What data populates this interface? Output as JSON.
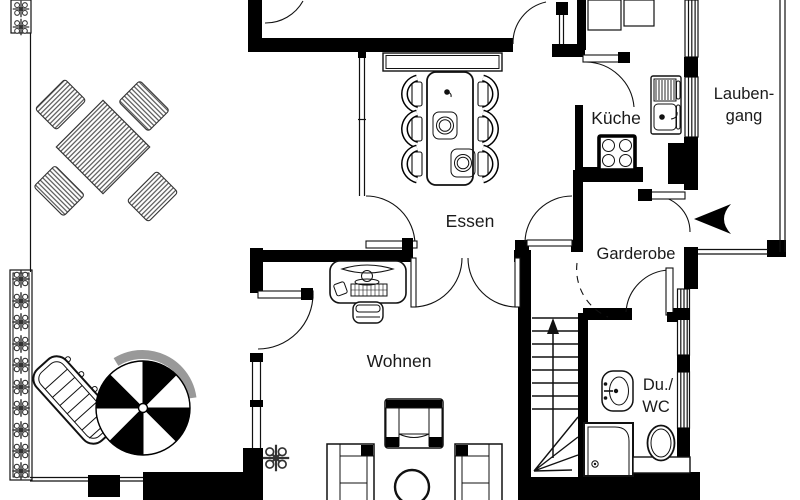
{
  "plan": {
    "type": "apartment-floor-plan",
    "rooms": {
      "essen": {
        "label": "Essen"
      },
      "kueche": {
        "label": "Küche"
      },
      "laubengang": {
        "label_lines": [
          "Lauben-",
          "gang"
        ]
      },
      "garderobe": {
        "label": "Garderobe"
      },
      "wohnen": {
        "label": "Wohnen"
      },
      "du_wc": {
        "label_lines": [
          "Du./",
          "WC"
        ]
      }
    },
    "colors": {
      "wall": "#000000",
      "background": "#ffffff",
      "line": "#111111",
      "parasol_shadow": "#999999"
    },
    "symbols": {
      "terrace": [
        "outdoor-dining-set",
        "parasol",
        "sun-lounger",
        "hedge"
      ],
      "essen": [
        "dining-table",
        "dining-chairs",
        "sideboard",
        "place-settings",
        "candle"
      ],
      "kueche": [
        "kitchen-counter",
        "dish-rack",
        "kitchen-sink",
        "stove"
      ],
      "wohnen": [
        "desk",
        "computer-monitor",
        "keyboard",
        "mouse",
        "office-chair",
        "sofa",
        "armchair",
        "coffee-table",
        "plant"
      ],
      "du_wc": [
        "washbasin",
        "shower",
        "toilet"
      ],
      "circulation": [
        "staircase",
        "stair-direction-arrow",
        "entrance-arrow",
        "door-swing",
        "window"
      ]
    }
  }
}
